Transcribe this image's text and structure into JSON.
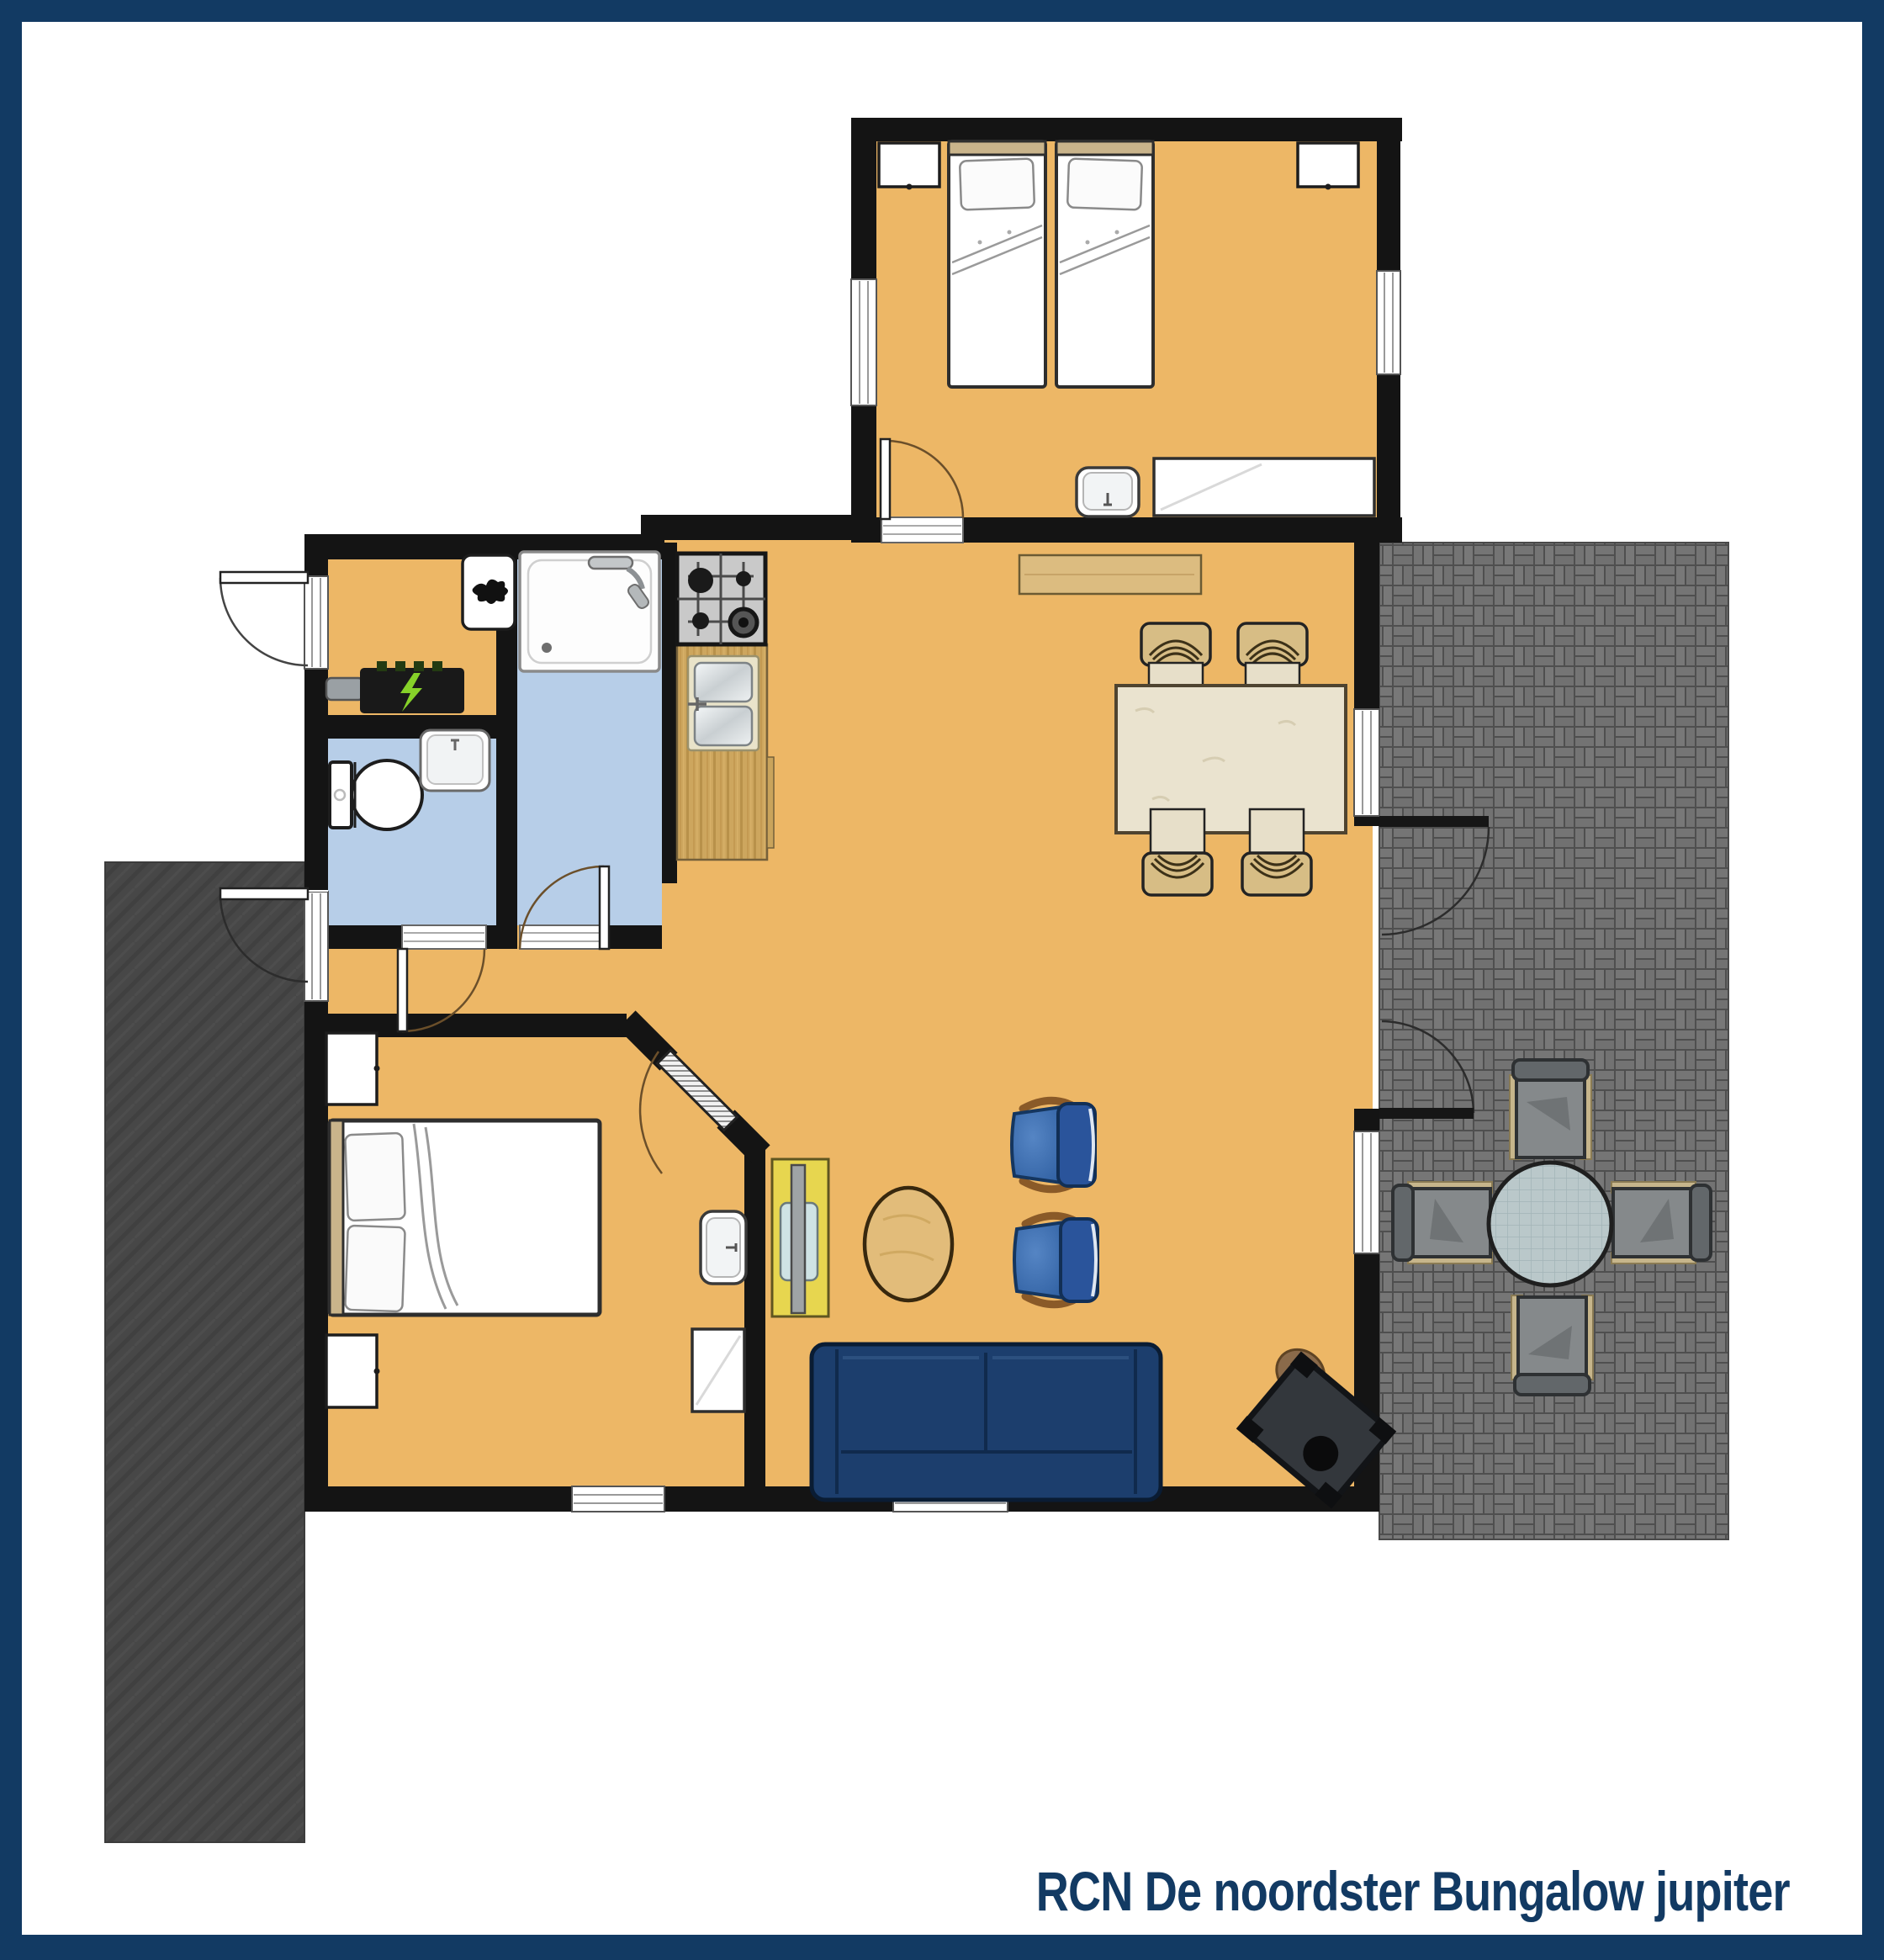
{
  "title": {
    "text": "RCN De noordster Bungalow jupiter"
  },
  "palette": {
    "frame_navy": "#123a63",
    "floor_orange": "#edb766",
    "wet_room_blue": "#b7cee8",
    "wall_black": "#141414",
    "patio_left_dark": "#474747",
    "patio_right_brick": "#767676",
    "patio_right_joint": "#4f4f4f",
    "counter_wood": "#cda65e",
    "dining_table_wood": "#eae3cf",
    "sideboard_wood": "#dcbc80",
    "sofa_navy": "#1c3e6d",
    "armchair_blue": "#2e5ea0",
    "tv_cabinet_yellow": "#e7d64f",
    "coffee_table_wood": "#e2bc7a",
    "outdoor_glass": "#bac8ca",
    "window_white": "#ffffff"
  },
  "rooms": [
    {
      "name": "twin-bedroom",
      "items": [
        "single-bed",
        "single-bed",
        "nightstand",
        "nightstand",
        "wash-basin",
        "cabinet",
        "window",
        "window",
        "door"
      ]
    },
    {
      "name": "living-dining-room",
      "items": [
        "dining-table",
        "dining-chair-x4",
        "sideboard",
        "sofa",
        "armchair-x2",
        "coffee-table",
        "tv-cabinet",
        "tv",
        "wood-stove",
        "french-doors",
        "window",
        "window"
      ]
    },
    {
      "name": "kitchen",
      "items": [
        "gas-hob",
        "double-sink",
        "counter"
      ]
    },
    {
      "name": "shower-room",
      "items": [
        "shower-tray",
        "shower-head",
        "door"
      ]
    },
    {
      "name": "toilet-room",
      "items": [
        "toilet",
        "corner-basin",
        "door"
      ]
    },
    {
      "name": "hallway",
      "items": [
        "boiler",
        "electric-meter",
        "front-door"
      ]
    },
    {
      "name": "double-bedroom",
      "items": [
        "double-bed",
        "nightstand",
        "nightstand",
        "wash-basin",
        "cabinet",
        "diagonal-door",
        "window"
      ]
    },
    {
      "name": "terrace-right",
      "items": [
        "round-glass-table",
        "patio-chair-x4"
      ]
    },
    {
      "name": "terrace-left",
      "items": [
        "side-door"
      ]
    }
  ]
}
